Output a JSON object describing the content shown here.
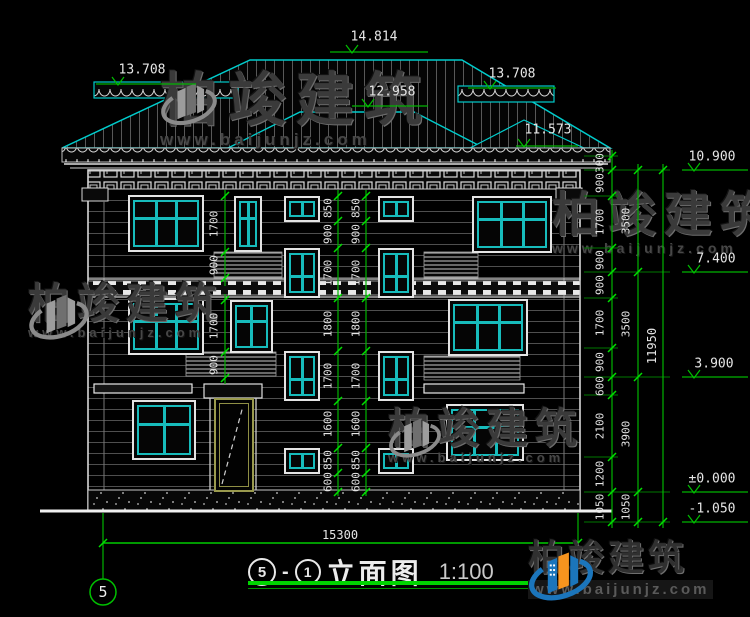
{
  "watermark": {
    "brand": "柏竣建筑",
    "url": "www.baijunjz.com"
  },
  "title": {
    "axis_from": "5",
    "sep": "-",
    "axis_to": "1",
    "name": "立面图",
    "scale": "1:100"
  },
  "axis_bubble": "5",
  "dims": {
    "roof_levels": {
      "ridge": "14.814",
      "left_eave": "13.708",
      "right_eave": "13.708",
      "mid": "12.958",
      "low_right": "11.573"
    },
    "levels": [
      "10.900",
      "7.400",
      "3.900",
      "±0.000",
      "-1.050"
    ],
    "right_inner": [
      "300",
      "900",
      "1700",
      "900",
      "900",
      "1700",
      "900",
      "600",
      "2100",
      "1200",
      "1050"
    ],
    "right_mid": [
      "3500",
      "3500",
      "3900",
      "1050"
    ],
    "right_total": "11950",
    "stair_chain": [
      "850",
      "900",
      "1700",
      "1800",
      "1700",
      "1600",
      "850",
      "600"
    ],
    "left_chain": [
      "1700",
      "900",
      "1700",
      "900"
    ],
    "total_width": "15300"
  }
}
